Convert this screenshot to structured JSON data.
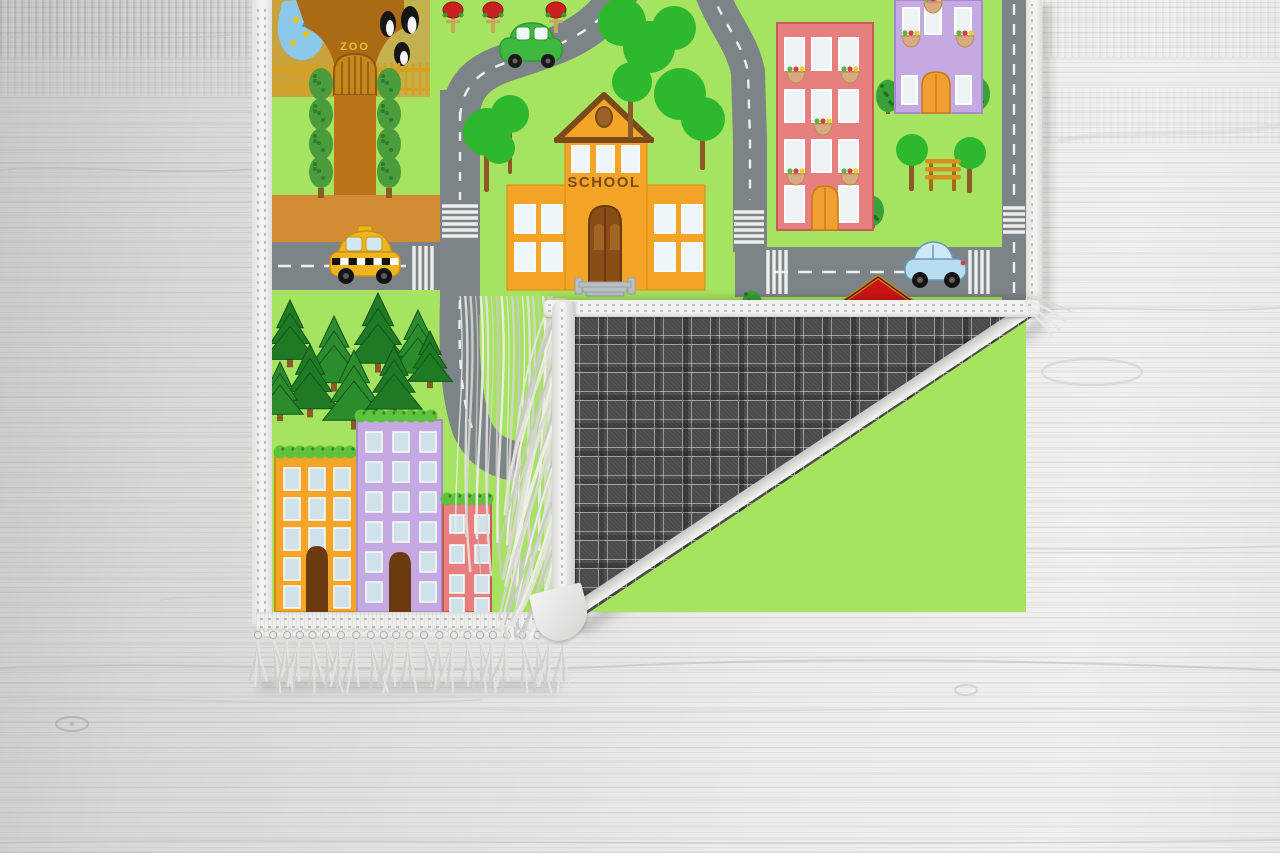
{
  "scene": {
    "description": "Product photo of a children's city road-map play rug lying on a whitewashed wooden floor; the bottom-right corner is folded over, revealing a dark gray plaid woven backing, a white bound edge and pale fringe tassels."
  },
  "rug": {
    "school_sign": "SCHOOL",
    "zoo_sign": "ZOO",
    "front_colors": {
      "grass": "#a6e360",
      "road": "#7d8487",
      "road_marking": "#efefef",
      "dirt_road": "#d18c34",
      "zoo_ground": "#c8a23c",
      "zoo_pen": "#c2b14e",
      "zoo_path": "#bc7418",
      "zoo_trunk": "#ab6b15",
      "fence_gold": "#d8a020",
      "pond_blue": "#8cc8ec",
      "school_orange": "#f4a527",
      "school_roof_brown": "#7a4a1a",
      "pink_building": "#e87f7f",
      "purple_building": "#c5a9e2",
      "orange_building": "#f4a527",
      "door_brown": "#6b3a10",
      "door_orange": "#f0a032",
      "taxi_yellow": "#f0b41e",
      "green_car": "#3eb83e",
      "blue_car": "#b8dcf0",
      "pine_green": "#1e7a24",
      "tree_green": "#2eb82e",
      "bush_green": "#3aa03a",
      "red_house_roof": "#cc1414",
      "red_tree": "#cc2020",
      "window_pane": "#eef4f6"
    },
    "back": {
      "plaid_base": "#4b4b4b",
      "plaid_line": "#eeeeee",
      "binding_white": "#f1f1ef",
      "fringe": "#e9e9e5"
    }
  },
  "floor": {
    "base_light": "#ececeb",
    "base_dark": "#c9c9c9",
    "grain": "#737373"
  }
}
